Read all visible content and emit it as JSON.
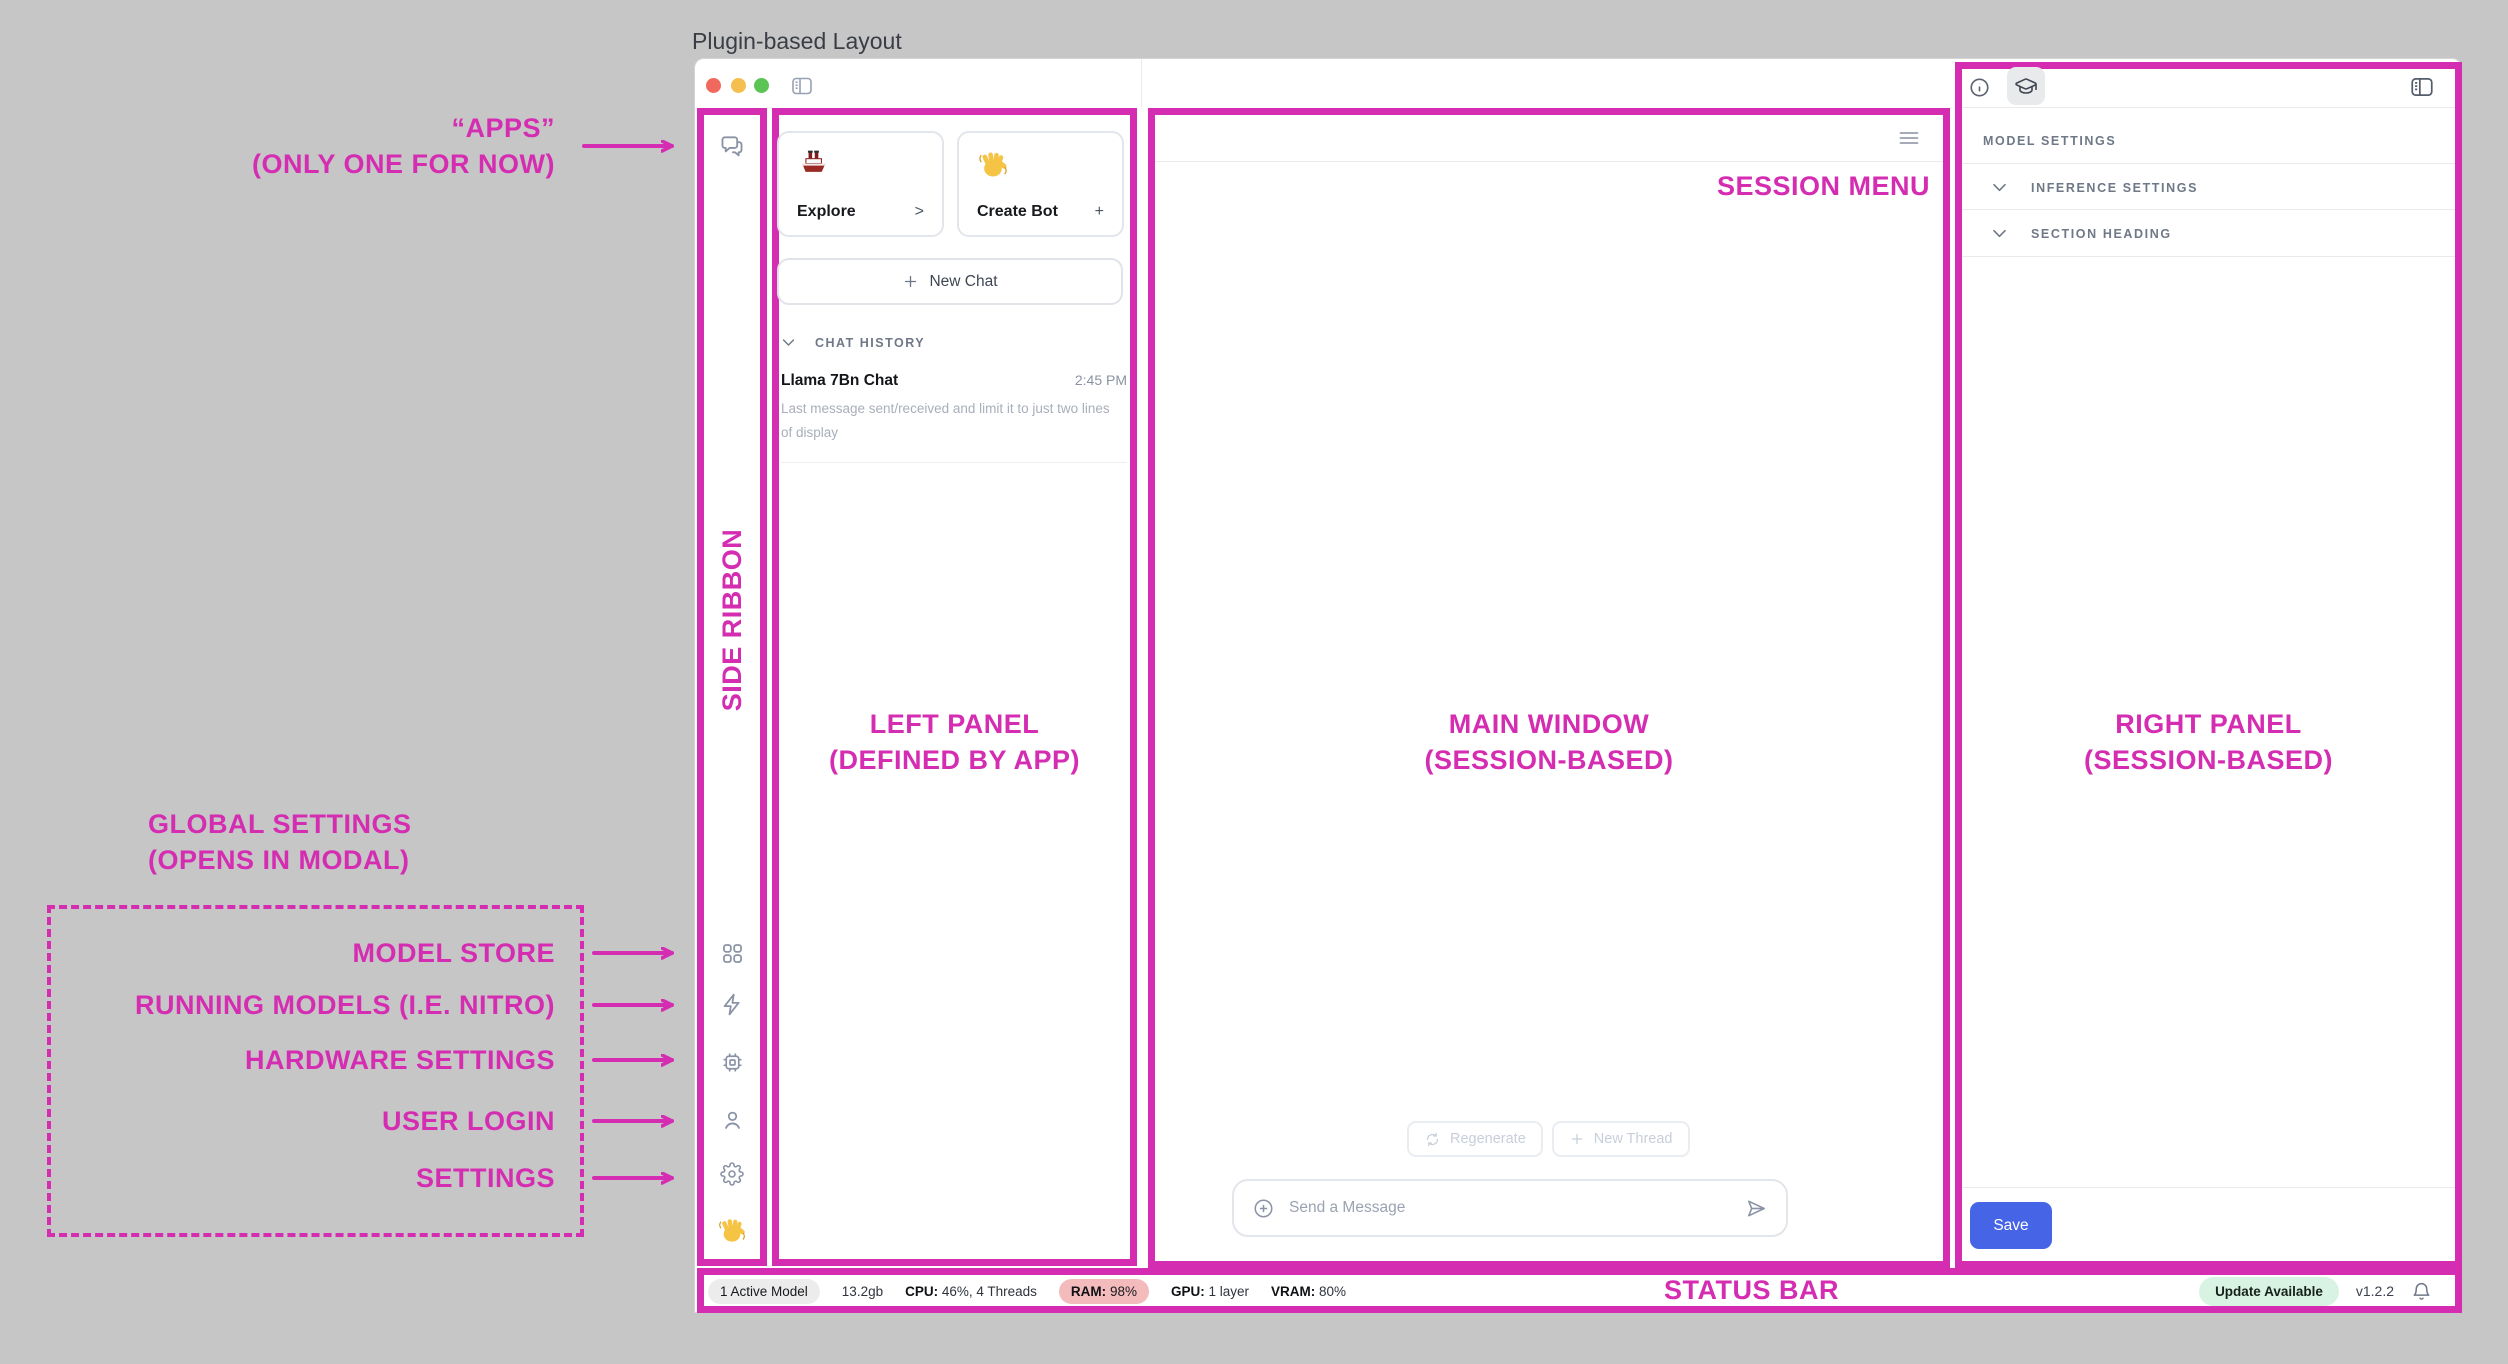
{
  "page_title": "Plugin-based Layout",
  "colors": {
    "annotation_pink": "#D52DB2",
    "save_blue": "#4565E6",
    "ram_pill": "#F4BBBD",
    "update_pill": "#D9F3E2"
  },
  "annotations": {
    "apps": {
      "line1": "“APPS”",
      "line2": "(ONLY ONE FOR NOW)"
    },
    "side_ribbon": "SIDE RIBBON",
    "left_panel": {
      "line1": "LEFT PANEL",
      "line2": "(DEFINED BY APP)"
    },
    "main_window": {
      "line1": "MAIN WINDOW",
      "line2": "(SESSION-BASED)"
    },
    "right_panel": {
      "line1": "RIGHT PANEL",
      "line2": "(SESSION-BASED)"
    },
    "session_menu": "SESSION MENU",
    "status_bar": "STATUS BAR",
    "global_settings": {
      "line1": "GLOBAL SETTINGS",
      "line2": "(OPENS IN MODAL)"
    },
    "ribbon_targets": [
      "MODEL STORE",
      "RUNNING MODELS (I.E. NITRO)",
      "HARDWARE SETTINGS",
      "USER LOGIN",
      "SETTINGS"
    ]
  },
  "window": {
    "left_panel": {
      "cards": [
        {
          "icon": "ship-emoji",
          "label": "Explore",
          "action": ">"
        },
        {
          "icon": "wave-emoji",
          "label": "Create Bot",
          "action": "+"
        }
      ],
      "new_chat_label": "New Chat",
      "history_header": "CHAT HISTORY",
      "chat_items": [
        {
          "title": "Llama 7Bn Chat",
          "time": "2:45 PM",
          "preview": "Last message sent/received and limit it to just two lines of display"
        }
      ]
    },
    "main": {
      "regenerate_label": "Regenerate",
      "new_thread_label": "New Thread",
      "composer_placeholder": "Send a Message"
    },
    "right_panel": {
      "heading": "MODEL SETTINGS",
      "section1": "INFERENCE SETTINGS",
      "section2": "SECTION HEADING",
      "save_label": "Save"
    },
    "status_bar": {
      "active_models": "1 Active Model",
      "memory": "13.2gb",
      "cpu_label": "CPU:",
      "cpu_value": "46%, 4 Threads",
      "ram_label": "RAM:",
      "ram_value": "98%",
      "gpu_label": "GPU:",
      "gpu_value": "1 layer",
      "vram_label": "VRAM:",
      "vram_value": "80%",
      "update_badge": "Update Available",
      "version": "v1.2.2"
    }
  }
}
